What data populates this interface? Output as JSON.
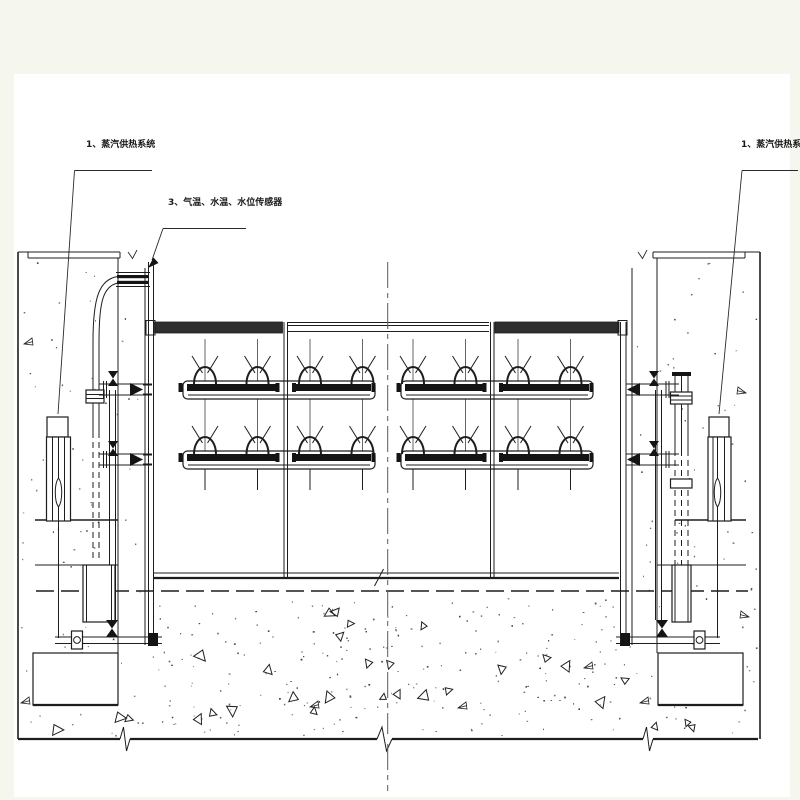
{
  "colors": {
    "background": "#f5f6ee",
    "paper": "#ffffff",
    "ink": "#1d1d1d",
    "thin_ink": "#555555",
    "centerline": "#5a5a5a",
    "dark_fill": "#141414"
  },
  "callouts": {
    "steam_left": {
      "text": "1、蒸汽供热系统"
    },
    "sensors": {
      "text": "3、气温、水温、水位传感器"
    },
    "steam_right": {
      "text": "1、蒸汽供热系统"
    }
  }
}
